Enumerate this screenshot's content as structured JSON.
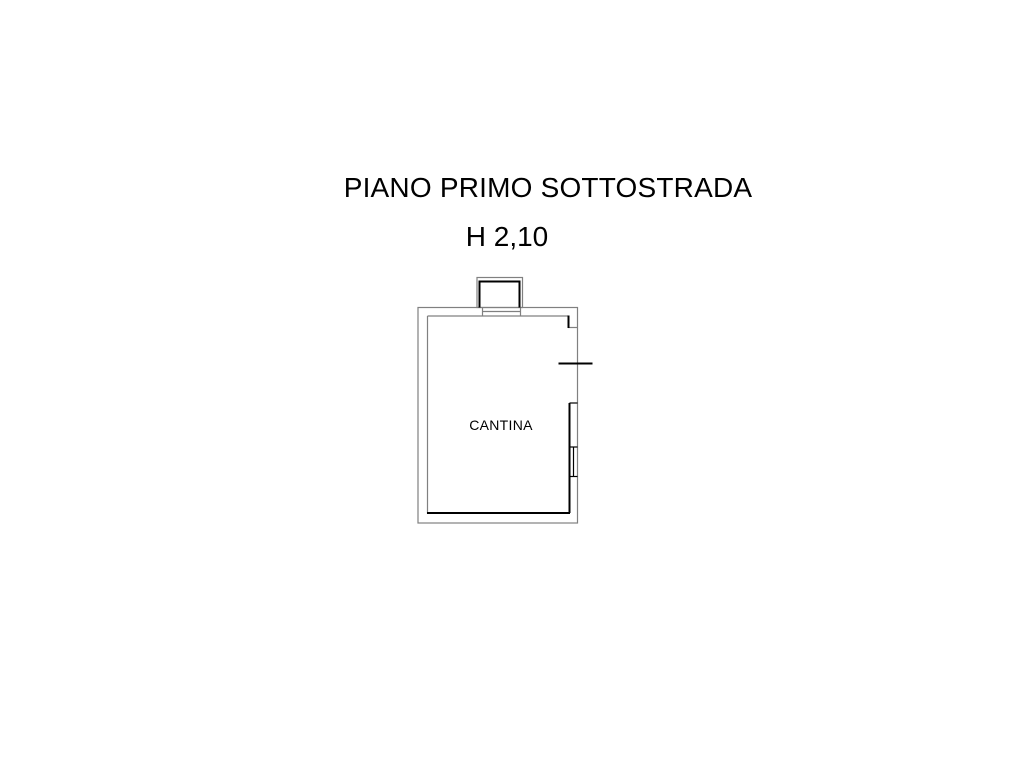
{
  "page": {
    "background": "#ffffff"
  },
  "titles": {
    "main": "PIANO PRIMO SOTTOSTRADA",
    "height": "H 2,10"
  },
  "floor_plan": {
    "room_label": "CANTINA",
    "colors": {
      "wall_outline": "#808080",
      "wall_inner": "#000000",
      "text": "#000000"
    },
    "features": {
      "light_well": "protruding box on top wall",
      "window_right_wall": "double opening with jamb lines",
      "opening_tick": "short horizontal mark crossing right wall"
    }
  }
}
